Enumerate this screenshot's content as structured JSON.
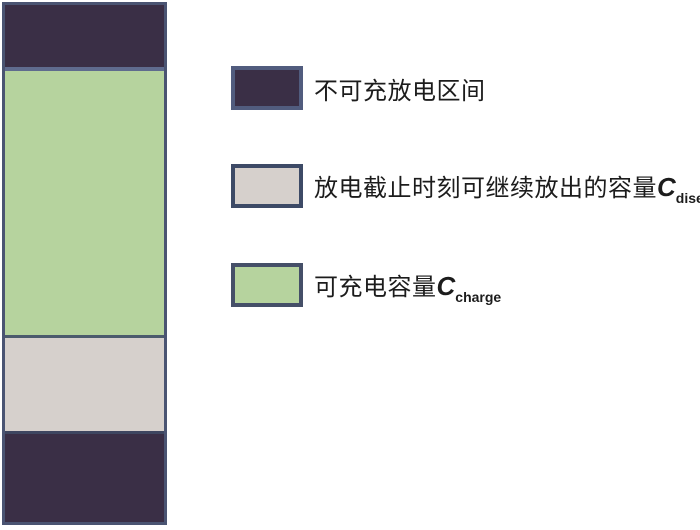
{
  "figure": {
    "type": "stacked-bar-with-legend",
    "description_colors": {
      "dark_region": "#3a2f46",
      "chargeable_green": "#b6d39e",
      "dischargeable_gray": "#d6d0cc",
      "bar_border": "#4a5472",
      "text": "#1c1c1c"
    }
  },
  "bar": {
    "segments": [
      {
        "name": "non-chargeable-top",
        "color": "#3a2f46",
        "height": "62px",
        "label": "不可充放电区间"
      },
      {
        "name": "chargeable-capacity",
        "color": "#b6d39e",
        "height": "264px",
        "label": "可充电容量Ccharge"
      },
      {
        "name": "remaining-discharge",
        "color": "#d6d0cc",
        "height": "93px",
        "label": "放电截止时刻可继续放出的容量Cdisend"
      },
      {
        "name": "non-chargeable-bottom",
        "color": "#3a2f46",
        "height": "",
        "label": "不可充放电区间"
      }
    ]
  },
  "legend": {
    "items": [
      {
        "label": "不可充放电区间",
        "symbol": "",
        "subscript": "",
        "swatch_color": "#3a2f46",
        "swatch_border": "#515c7e"
      },
      {
        "label": "放电截止时刻可继续放出的容量",
        "symbol": "C",
        "subscript": "disend",
        "swatch_color": "#d6d0cc",
        "swatch_border": "#3d4a66"
      },
      {
        "label": "可充电容量",
        "symbol": "C",
        "subscript": "charge",
        "swatch_color": "#b6d39e",
        "swatch_border": "#454f68"
      }
    ]
  }
}
